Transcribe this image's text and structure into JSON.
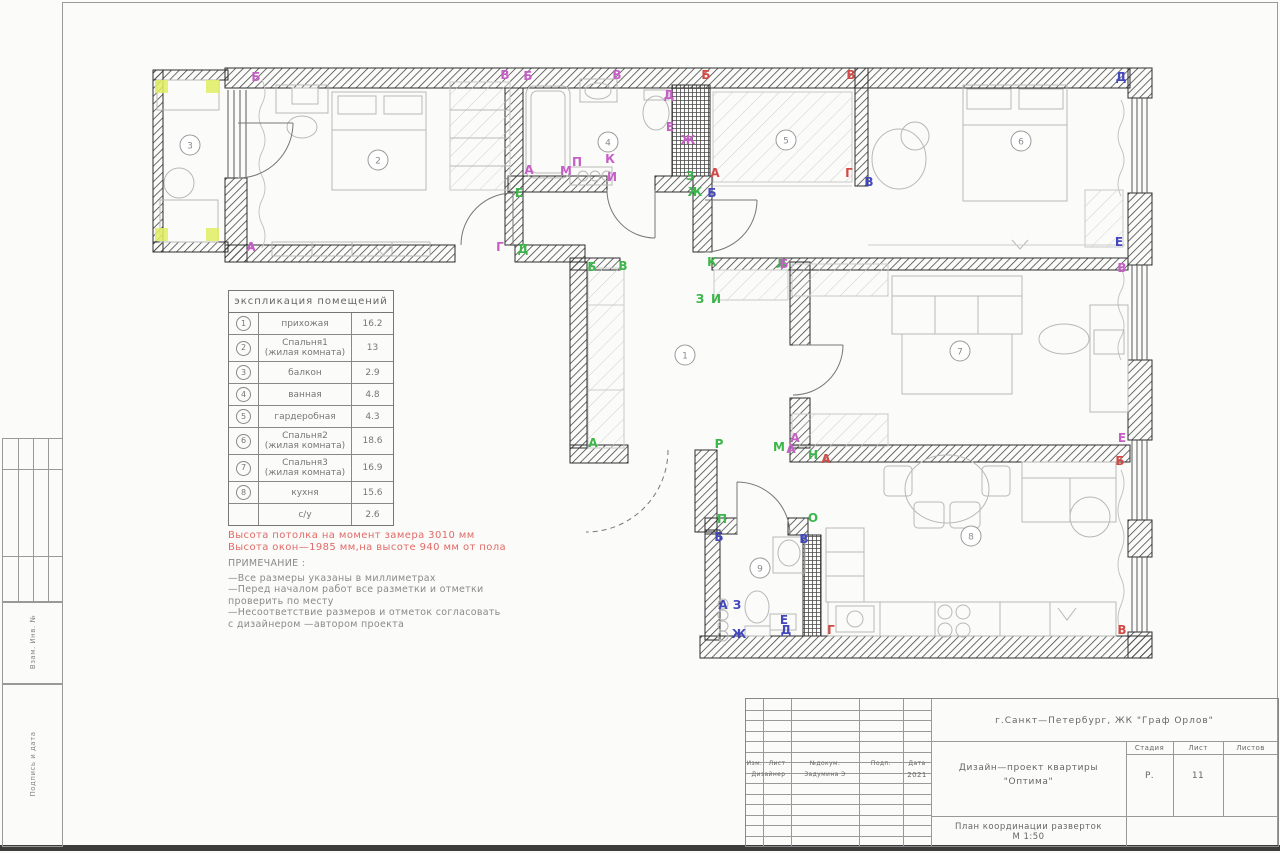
{
  "sheet": {
    "side_label_1": "Взам. Инв. №",
    "side_label_2": "Подпись и дата"
  },
  "legend": {
    "title": "экспликация помещений",
    "rows": [
      {
        "num": "1",
        "name": "прихожая",
        "name2": "",
        "area": "16.2"
      },
      {
        "num": "2",
        "name": "Спальня1",
        "name2": "(жилая комната)",
        "area": "13"
      },
      {
        "num": "3",
        "name": "балкон",
        "name2": "",
        "area": "2.9"
      },
      {
        "num": "4",
        "name": "ванная",
        "name2": "",
        "area": "4.8"
      },
      {
        "num": "5",
        "name": "гардеробная",
        "name2": "",
        "area": "4.3"
      },
      {
        "num": "6",
        "name": "Спальня2",
        "name2": "(жилая комната)",
        "area": "18.6"
      },
      {
        "num": "7",
        "name": "Спальня3",
        "name2": "(жилая комната)",
        "area": "16.9"
      },
      {
        "num": "8",
        "name": "кухня",
        "name2": "",
        "area": "15.6"
      },
      {
        "num": "",
        "name": "с/у",
        "name2": "",
        "area": "2.6"
      }
    ]
  },
  "notes_red": [
    "Высота потолка на момент замера 3010 мм",
    "Высота окон—1985 мм,на высоте 940 мм от пола"
  ],
  "notes": {
    "title": "ПРИМЕЧАНИЕ :",
    "lines": [
      "—Все размеры указаны в миллиметрах",
      "—Перед началом работ все разметки и отметки",
      "проверить по месту",
      "—Несоответствие размеров и отметок согласовать",
      "с дизайнером —автором проекта"
    ]
  },
  "titleblock": {
    "address": "г.Санкт—Петербург, ЖК \"Граф Орлов\"",
    "col_izm": "Изм.",
    "col_list": "Лист",
    "col_dok": "№докум.",
    "col_podp": "Подп.",
    "col_data": "Дата",
    "role": "Дизайнер",
    "name": "Задумина Э",
    "date": "2021",
    "project": "Дизайн—проект квартиры",
    "project2": "\"Оптима\"",
    "stage_label": "Стадия",
    "sheet_label": "Лист",
    "sheets_label": "Листов",
    "stage": "Р.",
    "sheet_num": "11",
    "sheets": "",
    "doc_title": "План координации разверток",
    "scale": "М 1:50"
  },
  "colors": {
    "green": "#3cb54a",
    "magenta": "#c55fc5",
    "red": "#d24a45",
    "blue": "#4348bd",
    "highlight": "#e1ef62"
  },
  "plan": {
    "rooms": [
      {
        "num": "1",
        "x": 685,
        "y": 355
      },
      {
        "num": "2",
        "x": 378,
        "y": 160
      },
      {
        "num": "3",
        "x": 190,
        "y": 145
      },
      {
        "num": "4",
        "x": 608,
        "y": 142
      },
      {
        "num": "5",
        "x": 786,
        "y": 140
      },
      {
        "num": "6",
        "x": 1021,
        "y": 141
      },
      {
        "num": "7",
        "x": 960,
        "y": 351
      },
      {
        "num": "8",
        "x": 971,
        "y": 536
      },
      {
        "num": "9",
        "x": 760,
        "y": 568
      }
    ],
    "markers": [
      {
        "t": "А",
        "c": "green",
        "x": 593,
        "y": 447
      },
      {
        "t": "Б",
        "c": "green",
        "x": 592,
        "y": 271
      },
      {
        "t": "В",
        "c": "green",
        "x": 623,
        "y": 270
      },
      {
        "t": "Д",
        "c": "green",
        "x": 523,
        "y": 253
      },
      {
        "t": "Е",
        "c": "green",
        "x": 519,
        "y": 197
      },
      {
        "t": "Ж",
        "c": "green",
        "x": 695,
        "y": 196
      },
      {
        "t": "З",
        "c": "green",
        "x": 690,
        "y": 180
      },
      {
        "t": "З",
        "c": "green",
        "x": 700,
        "y": 303
      },
      {
        "t": "И",
        "c": "green",
        "x": 716,
        "y": 303
      },
      {
        "t": "К",
        "c": "green",
        "x": 712,
        "y": 266
      },
      {
        "t": "Л",
        "c": "green",
        "x": 781,
        "y": 268
      },
      {
        "t": "М",
        "c": "green",
        "x": 779,
        "y": 451
      },
      {
        "t": "Н",
        "c": "green",
        "x": 813,
        "y": 459
      },
      {
        "t": "О",
        "c": "green",
        "x": 813,
        "y": 522
      },
      {
        "t": "П",
        "c": "green",
        "x": 722,
        "y": 523
      },
      {
        "t": "Р",
        "c": "green",
        "x": 719,
        "y": 448
      },
      {
        "t": "Б",
        "c": "magenta",
        "x": 256,
        "y": 81
      },
      {
        "t": "В",
        "c": "magenta",
        "x": 505,
        "y": 79
      },
      {
        "t": "А",
        "c": "magenta",
        "x": 251,
        "y": 251
      },
      {
        "t": "Г",
        "c": "magenta",
        "x": 500,
        "y": 251
      },
      {
        "t": "Б",
        "c": "magenta",
        "x": 528,
        "y": 80
      },
      {
        "t": "В",
        "c": "magenta",
        "x": 617,
        "y": 79
      },
      {
        "t": "Д",
        "c": "magenta",
        "x": 669,
        "y": 99
      },
      {
        "t": "Е",
        "c": "magenta",
        "x": 670,
        "y": 131
      },
      {
        "t": "Ж",
        "c": "magenta",
        "x": 688,
        "y": 144
      },
      {
        "t": "И",
        "c": "magenta",
        "x": 612,
        "y": 181
      },
      {
        "t": "К",
        "c": "magenta",
        "x": 610,
        "y": 163
      },
      {
        "t": "П",
        "c": "magenta",
        "x": 577,
        "y": 166
      },
      {
        "t": "М",
        "c": "magenta",
        "x": 566,
        "y": 175
      },
      {
        "t": "А",
        "c": "magenta",
        "x": 529,
        "y": 174
      },
      {
        "t": "Б",
        "c": "red",
        "x": 706,
        "y": 79
      },
      {
        "t": "В",
        "c": "red",
        "x": 851,
        "y": 79
      },
      {
        "t": "А",
        "c": "red",
        "x": 715,
        "y": 177
      },
      {
        "t": "Г",
        "c": "red",
        "x": 849,
        "y": 177
      },
      {
        "t": "Д",
        "c": "blue",
        "x": 1121,
        "y": 81
      },
      {
        "t": "В",
        "c": "blue",
        "x": 869,
        "y": 186
      },
      {
        "t": "Е",
        "c": "blue",
        "x": 1119,
        "y": 246
      },
      {
        "t": "Б",
        "c": "blue",
        "x": 712,
        "y": 197
      },
      {
        "t": "Б",
        "c": "magenta",
        "x": 784,
        "y": 268
      },
      {
        "t": "В",
        "c": "magenta",
        "x": 1122,
        "y": 272
      },
      {
        "t": "А",
        "c": "magenta",
        "x": 795,
        "y": 442
      },
      {
        "t": "Е",
        "c": "magenta",
        "x": 1122,
        "y": 442
      },
      {
        "t": "А",
        "c": "magenta",
        "x": 791,
        "y": 453
      },
      {
        "t": "А",
        "c": "red",
        "x": 826,
        "y": 463
      },
      {
        "t": "Б",
        "c": "red",
        "x": 1120,
        "y": 465
      },
      {
        "t": "В",
        "c": "red",
        "x": 1122,
        "y": 634
      },
      {
        "t": "Г",
        "c": "red",
        "x": 831,
        "y": 634
      },
      {
        "t": "Б",
        "c": "blue",
        "x": 719,
        "y": 541
      },
      {
        "t": "В",
        "c": "blue",
        "x": 804,
        "y": 543
      },
      {
        "t": "А",
        "c": "blue",
        "x": 723,
        "y": 609
      },
      {
        "t": "З",
        "c": "blue",
        "x": 737,
        "y": 609
      },
      {
        "t": "Ж",
        "c": "blue",
        "x": 739,
        "y": 638
      },
      {
        "t": "Е",
        "c": "blue",
        "x": 784,
        "y": 624
      },
      {
        "t": "Д",
        "c": "blue",
        "x": 786,
        "y": 634
      }
    ]
  }
}
